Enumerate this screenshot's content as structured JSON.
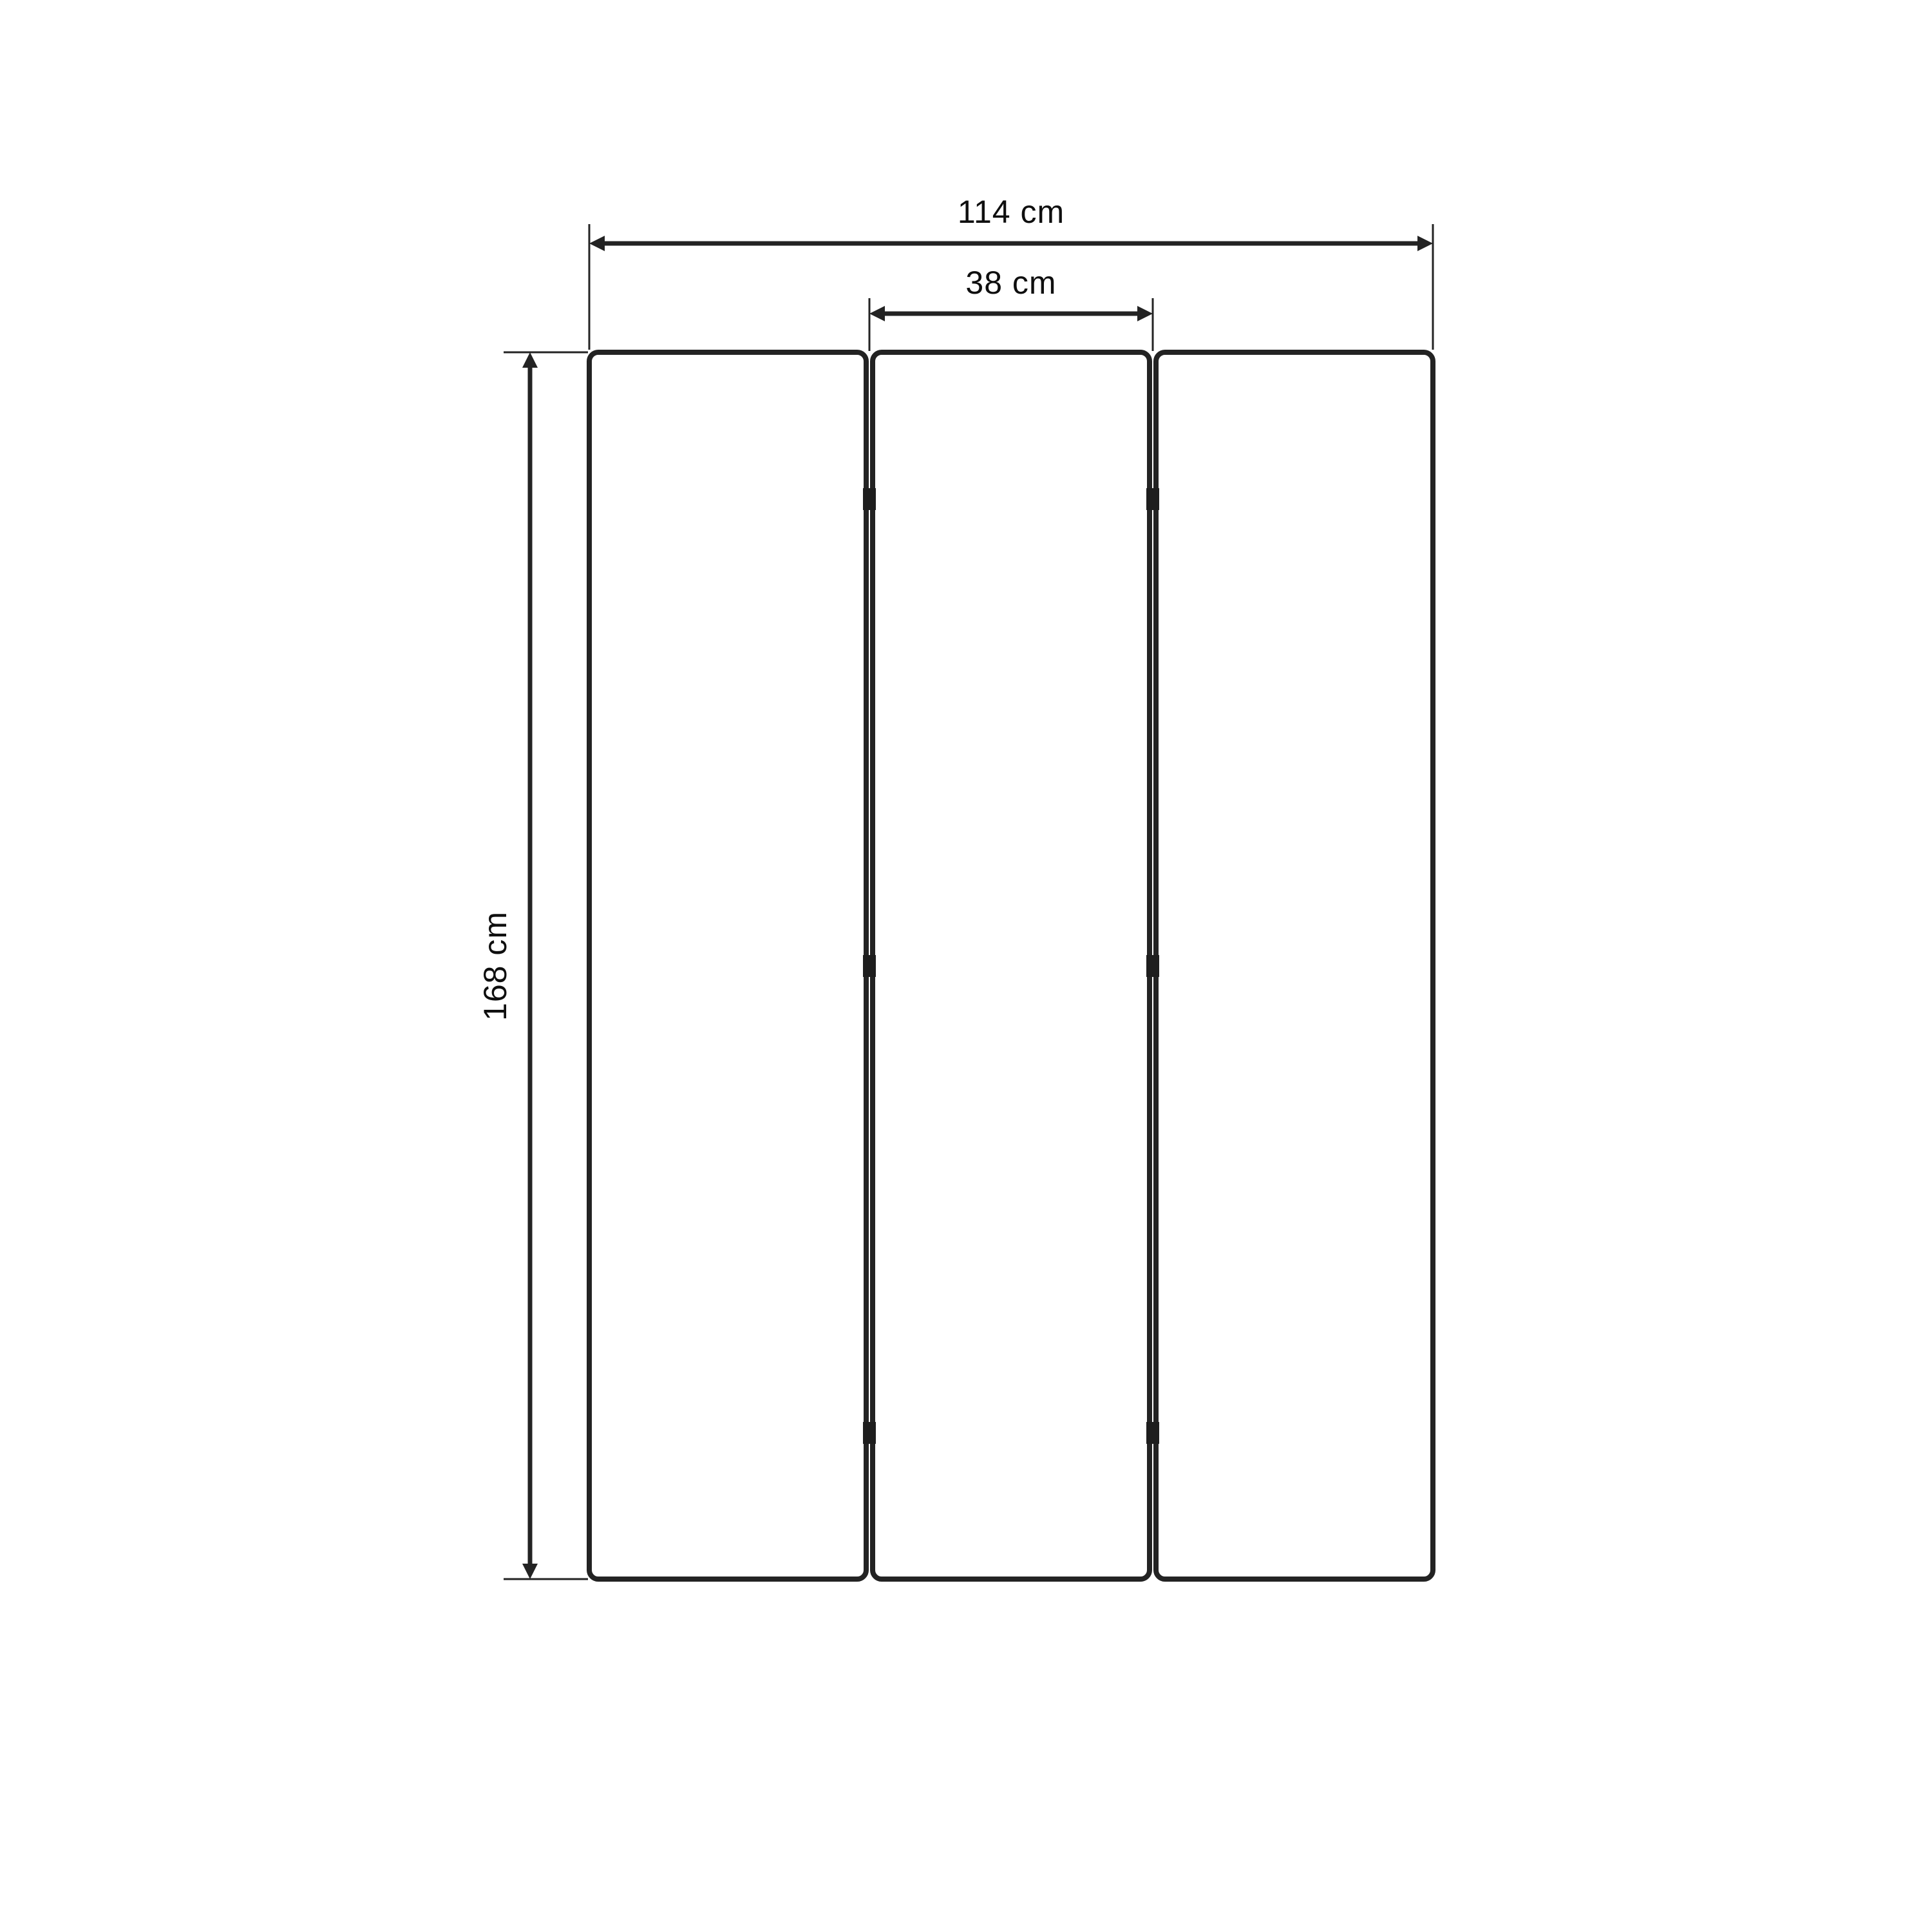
{
  "drawing": {
    "unit": "cm",
    "background_color": "#ffffff",
    "line_color": "#232323",
    "text_color": "#0f0f0f",
    "panel_count": 3,
    "hinge_count": 6,
    "labels": {
      "total_width": "114 cm",
      "panel_width": "38 cm",
      "height": "168 cm"
    },
    "values": {
      "total_width_cm": 114,
      "panel_width_cm": 38,
      "height_cm": 168
    }
  }
}
